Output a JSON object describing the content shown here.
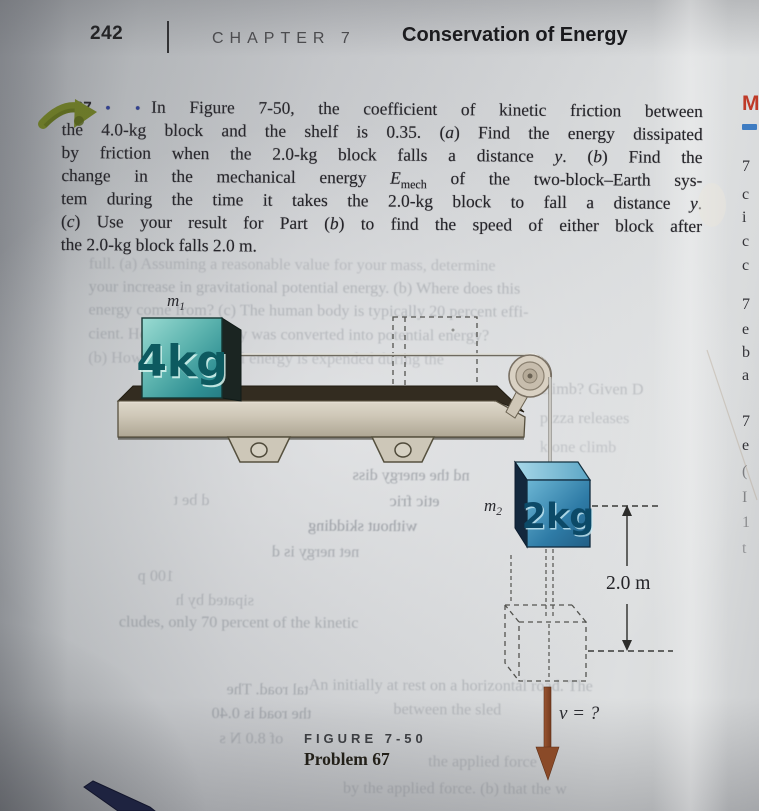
{
  "header": {
    "page_number": "242",
    "chapter_label": "CHAPTER 7",
    "chapter_title": "Conservation of Energy"
  },
  "problem": {
    "number": "67",
    "difficulty_dots": "• •",
    "lines": [
      [
        {
          "t": "67",
          "s": "num"
        },
        {
          "t": "• •",
          "s": "dots"
        },
        {
          "t": "In Figure 7-50, the coefficient of kinetic friction between"
        }
      ],
      [
        {
          "t": "the 4.0-kg block and the shelf is 0.35. ("
        },
        {
          "t": "a",
          "s": "i"
        },
        {
          "t": ") Find the energy dissipated"
        }
      ],
      [
        {
          "t": "by friction when the 2.0-kg block falls a distance "
        },
        {
          "t": "y",
          "s": "i"
        },
        {
          "t": ". ("
        },
        {
          "t": "b",
          "s": "i"
        },
        {
          "t": ") Find the"
        }
      ],
      [
        {
          "t": "change in the mechanical energy "
        },
        {
          "t": "E",
          "s": "i"
        },
        {
          "t": "mech",
          "s": "sub"
        },
        {
          "t": " of the two-block–Earth sys-"
        }
      ],
      [
        {
          "t": "tem during the time it takes the 2.0-kg block to fall a distance "
        },
        {
          "t": "y",
          "s": "i"
        },
        {
          "t": "."
        }
      ],
      [
        {
          "t": "("
        },
        {
          "t": "c",
          "s": "i"
        },
        {
          "t": ") Use your result for Part ("
        },
        {
          "t": "b",
          "s": "i"
        },
        {
          "t": ") to find the speed of either block after"
        }
      ],
      [
        {
          "t": "the 2.0-kg block falls 2.0 m."
        }
      ]
    ]
  },
  "figure": {
    "mass1_label": "m",
    "mass1_sub": "1",
    "mass2_label": "m",
    "mass2_sub": "2",
    "block1_text": "4kg",
    "block2_text": "2kg",
    "distance_label": "2.0 m",
    "velocity_label": "v = ?",
    "caption_line1": "FIGURE 7-50",
    "caption_line2": "Problem 67"
  },
  "ghost_text": {
    "lines": [
      {
        "t": "full. (a) Assuming a reasonable value for your mass, determine",
        "x": 88,
        "y": 256,
        "w": 614,
        "m": 0,
        "o": 0.26
      },
      {
        "t": "your increase in gravitational potential energy. (b) Where does this",
        "x": 88,
        "y": 279,
        "w": 614,
        "m": 0,
        "o": 0.32
      },
      {
        "t": "energy come from? (c) The human body is typically 20 percent effi-",
        "x": 88,
        "y": 302,
        "w": 614,
        "m": 0,
        "o": 0.3
      },
      {
        "t": "cient. How much energy was converted into potential energy?",
        "x": 88,
        "y": 326,
        "w": 614,
        "m": 0,
        "o": 0.3
      },
      {
        "t": "(b) How much chemical energy is expended during the",
        "x": 88,
        "y": 350,
        "w": 614,
        "m": 0,
        "o": 0.26
      },
      {
        "t": "climb? Given D",
        "x": 540,
        "y": 379,
        "w": 160,
        "m": 0,
        "o": 0.28
      },
      {
        "t": "pizza releases",
        "x": 540,
        "y": 408,
        "w": 150,
        "m": 0,
        "o": 0.26
      },
      {
        "t": "k one climb",
        "x": 540,
        "y": 437,
        "w": 150,
        "m": 0,
        "o": 0.24
      },
      {
        "t": "nd the energy diss",
        "x": 255,
        "y": 466,
        "w": 215,
        "m": 1,
        "o": 0.48
      },
      {
        "t": "d be t",
        "x": 120,
        "y": 492,
        "w": 90,
        "m": 1,
        "o": 0.3
      },
      {
        "t": "etic fric",
        "x": 300,
        "y": 492,
        "w": 140,
        "m": 1,
        "o": 0.5
      },
      {
        "t": "without skidding",
        "x": 118,
        "y": 517,
        "w": 300,
        "m": 1,
        "o": 0.52
      },
      {
        "t": "net    nergy is d",
        "x": 125,
        "y": 543,
        "w": 235,
        "m": 1,
        "o": 0.42
      },
      {
        "t": "100 p",
        "x": 85,
        "y": 568,
        "w": 90,
        "m": 1,
        "o": 0.3
      },
      {
        "t": "sipated by h",
        "x": 80,
        "y": 592,
        "w": 175,
        "m": 1,
        "o": 0.3
      },
      {
        "t": "cludes, only 70 percent of the kinetic",
        "x": 120,
        "y": 614,
        "w": 360,
        "m": 0,
        "o": 0.38
      },
      {
        "t": "An      initially at rest on a horizontal road. The",
        "x": 310,
        "y": 676,
        "w": 375,
        "m": 0,
        "o": 0.3
      },
      {
        "t": "tal road. The",
        "x": 95,
        "y": 681,
        "w": 215,
        "m": 1,
        "o": 0.38
      },
      {
        "t": "the road is 0.40",
        "x": 78,
        "y": 705,
        "w": 235,
        "m": 1,
        "o": 0.4
      },
      {
        "t": "of 8.0 N s",
        "x": 90,
        "y": 730,
        "w": 195,
        "m": 1,
        "o": 0.32
      },
      {
        "t": "between the sled",
        "x": 395,
        "y": 700,
        "w": 230,
        "m": 0,
        "o": 0.28
      },
      {
        "t": "the applied force",
        "x": 430,
        "y": 752,
        "w": 230,
        "m": 0,
        "o": 0.28
      },
      {
        "t": "by the applied force. (b) that the w",
        "x": 345,
        "y": 779,
        "w": 300,
        "m": 0,
        "o": 0.28
      }
    ]
  },
  "right_edge": {
    "heading_letter": "M",
    "letters": [
      {
        "ch": "7",
        "y": 158
      },
      {
        "ch": "c",
        "y": 186
      },
      {
        "ch": "i",
        "y": 209
      },
      {
        "ch": "c",
        "y": 233
      },
      {
        "ch": "c",
        "y": 257
      },
      {
        "ch": "7",
        "y": 296
      },
      {
        "ch": "e",
        "y": 321
      },
      {
        "ch": "b",
        "y": 344
      },
      {
        "ch": "a",
        "y": 367
      },
      {
        "ch": "7",
        "y": 413
      },
      {
        "ch": "e",
        "y": 437
      },
      {
        "ch": "(",
        "y": 463,
        "o": 0.55
      },
      {
        "ch": "I",
        "y": 489,
        "o": 0.5
      },
      {
        "ch": "1",
        "y": 514,
        "o": 0.45
      },
      {
        "ch": "t",
        "y": 540,
        "o": 0.4
      }
    ]
  },
  "colors": {
    "accent_arrow_green": "#6a7823",
    "fall_arrow_brown": "#8a4a28",
    "block1_teal": "#2f8f93",
    "block2_blue": "#2e7ba6",
    "difficulty_dots_blue": "#2e3d8f",
    "heading_red": "#bf3a28",
    "underline_blue": "#3e7cc2"
  }
}
